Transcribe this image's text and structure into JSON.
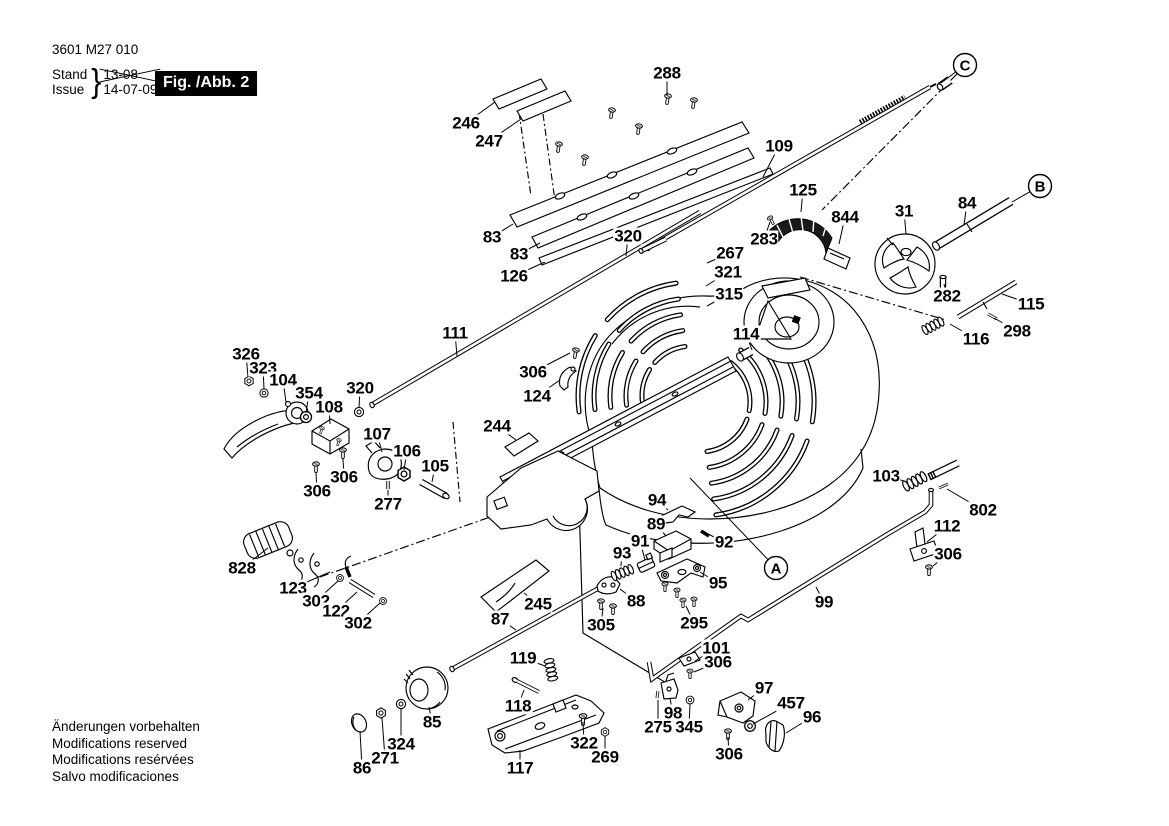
{
  "header": {
    "part_number": "3601 M27 010",
    "stand_label": "Stand",
    "issue_label": "Issue",
    "brace": "}",
    "stand_value": "13-08",
    "issue_value": "14-07-09",
    "figure_label": "Fig. /Abb. 2"
  },
  "footer": {
    "lines": [
      "Änderungen vorbehalten",
      "Modifications reserved",
      "Modifications resérvées",
      "Salvo modificaciones"
    ]
  },
  "colors": {
    "ink": "#000000",
    "paper": "#ffffff",
    "figure_box_bg": "#000000",
    "figure_box_text": "#ffffff"
  },
  "callouts": [
    {
      "letter": "A",
      "x": 776,
      "y": 568,
      "lx": 690,
      "ly": 478
    },
    {
      "letter": "B",
      "x": 1040,
      "y": 186,
      "lx": 1012,
      "ly": 202
    },
    {
      "letter": "C",
      "x": 965,
      "y": 65,
      "lx": 941,
      "ly": 83
    }
  ],
  "part_labels": [
    {
      "text": "288",
      "x": 667,
      "y": 73,
      "lx": 667,
      "ly": 96
    },
    {
      "text": "246",
      "x": 466,
      "y": 123,
      "lx": 495,
      "ly": 102
    },
    {
      "text": "247",
      "x": 489,
      "y": 141,
      "lx": 521,
      "ly": 119
    },
    {
      "text": "83",
      "x": 492,
      "y": 237,
      "lx": 513,
      "ly": 224
    },
    {
      "text": "83",
      "x": 519,
      "y": 254,
      "lx": 540,
      "ly": 243
    },
    {
      "text": "126",
      "x": 514,
      "y": 276,
      "lx": 545,
      "ly": 262
    },
    {
      "text": "320",
      "x": 628,
      "y": 236,
      "lx": 626,
      "ly": 256
    },
    {
      "text": "109",
      "x": 779,
      "y": 146,
      "lx": 763,
      "ly": 177
    },
    {
      "text": "125",
      "x": 803,
      "y": 190,
      "lx": 801,
      "ly": 212
    },
    {
      "text": "844",
      "x": 845,
      "y": 217,
      "lx": 839,
      "ly": 244
    },
    {
      "text": "283",
      "x": 764,
      "y": 239,
      "lx": 770,
      "ly": 222
    },
    {
      "text": "267",
      "x": 730,
      "y": 253,
      "lx": 707,
      "ly": 263
    },
    {
      "text": "321",
      "x": 728,
      "y": 272,
      "lx": 706,
      "ly": 286
    },
    {
      "text": "315",
      "x": 729,
      "y": 294,
      "lx": 707,
      "ly": 306
    },
    {
      "text": "31",
      "x": 904,
      "y": 211,
      "lx": 906,
      "ly": 234
    },
    {
      "text": "84",
      "x": 967,
      "y": 203,
      "lx": 964,
      "ly": 225
    },
    {
      "text": "282",
      "x": 947,
      "y": 296,
      "lx": 944,
      "ly": 284
    },
    {
      "text": "115",
      "x": 1031,
      "y": 304,
      "lx": 1002,
      "ly": 294
    },
    {
      "text": "298",
      "x": 1017,
      "y": 331,
      "lx": 994,
      "ly": 318
    },
    {
      "text": "116",
      "x": 976,
      "y": 339,
      "lx": 950,
      "ly": 324
    },
    {
      "text": "111",
      "x": 455,
      "y": 333,
      "lx": 457,
      "ly": 356
    },
    {
      "text": "114",
      "x": 746,
      "y": 334,
      "lx": 752,
      "ly": 350
    },
    {
      "text": "306",
      "x": 533,
      "y": 372,
      "lx": 570,
      "ly": 353
    },
    {
      "text": "124",
      "x": 537,
      "y": 396,
      "lx": 560,
      "ly": 380
    },
    {
      "text": "244",
      "x": 497,
      "y": 426,
      "lx": 516,
      "ly": 440
    },
    {
      "text": "326",
      "x": 246,
      "y": 354,
      "lx": 248,
      "ly": 377
    },
    {
      "text": "323",
      "x": 263,
      "y": 368,
      "lx": 264,
      "ly": 389
    },
    {
      "text": "104",
      "x": 283,
      "y": 380,
      "lx": 286,
      "ly": 402
    },
    {
      "text": "354",
      "x": 309,
      "y": 393,
      "lx": 306,
      "ly": 413
    },
    {
      "text": "108",
      "x": 329,
      "y": 407,
      "lx": 330,
      "ly": 424
    },
    {
      "text": "320",
      "x": 360,
      "y": 388,
      "lx": 359,
      "ly": 408
    },
    {
      "text": "107",
      "x": 377,
      "y": 434,
      "lx": 382,
      "ly": 452
    },
    {
      "text": "106",
      "x": 407,
      "y": 451,
      "lx": 404,
      "ly": 470
    },
    {
      "text": "105",
      "x": 435,
      "y": 466,
      "lx": 432,
      "ly": 482
    },
    {
      "text": "306",
      "x": 344,
      "y": 477,
      "lx": 343,
      "ly": 459
    },
    {
      "text": "306",
      "x": 317,
      "y": 491,
      "lx": 316,
      "ly": 473
    },
    {
      "text": "277",
      "x": 388,
      "y": 504,
      "lx": 388,
      "ly": 490
    },
    {
      "text": "828",
      "x": 242,
      "y": 568,
      "lx": 268,
      "ly": 548
    },
    {
      "text": "123",
      "x": 293,
      "y": 588,
      "lx": 330,
      "ly": 572
    },
    {
      "text": "302",
      "x": 316,
      "y": 601,
      "lx": 338,
      "ly": 581
    },
    {
      "text": "122",
      "x": 336,
      "y": 611,
      "lx": 357,
      "ly": 592
    },
    {
      "text": "302",
      "x": 358,
      "y": 623,
      "lx": 380,
      "ly": 603
    },
    {
      "text": "87",
      "x": 500,
      "y": 619,
      "lx": 516,
      "ly": 630
    },
    {
      "text": "245",
      "x": 538,
      "y": 604,
      "lx": 524,
      "ly": 593
    },
    {
      "text": "305",
      "x": 601,
      "y": 625,
      "lx": 603,
      "ly": 608
    },
    {
      "text": "88",
      "x": 636,
      "y": 601,
      "lx": 620,
      "ly": 589
    },
    {
      "text": "93",
      "x": 622,
      "y": 553,
      "lx": 621,
      "ly": 566
    },
    {
      "text": "91",
      "x": 640,
      "y": 541,
      "lx": 645,
      "ly": 560
    },
    {
      "text": "89",
      "x": 656,
      "y": 524,
      "lx": 666,
      "ly": 536
    },
    {
      "text": "94",
      "x": 657,
      "y": 500,
      "lx": 668,
      "ly": 510
    },
    {
      "text": "92",
      "x": 724,
      "y": 542,
      "lx": 708,
      "ly": 534
    },
    {
      "text": "95",
      "x": 718,
      "y": 583,
      "lx": 700,
      "ly": 572
    },
    {
      "text": "295",
      "x": 694,
      "y": 623,
      "lx": 686,
      "ly": 606
    },
    {
      "text": "99",
      "x": 824,
      "y": 602,
      "lx": 816,
      "ly": 587
    },
    {
      "text": "103",
      "x": 886,
      "y": 476,
      "lx": 904,
      "ly": 481
    },
    {
      "text": "802",
      "x": 983,
      "y": 510,
      "lx": 947,
      "ly": 489
    },
    {
      "text": "112",
      "x": 947,
      "y": 526,
      "lx": 927,
      "ly": 542
    },
    {
      "text": "306",
      "x": 948,
      "y": 554,
      "lx": 933,
      "ly": 566
    },
    {
      "text": "101",
      "x": 716,
      "y": 648,
      "lx": 695,
      "ly": 661
    },
    {
      "text": "306",
      "x": 718,
      "y": 662,
      "lx": 694,
      "ly": 672
    },
    {
      "text": "119",
      "x": 523,
      "y": 658,
      "lx": 545,
      "ly": 666
    },
    {
      "text": "118",
      "x": 518,
      "y": 706,
      "lx": 524,
      "ly": 690
    },
    {
      "text": "85",
      "x": 432,
      "y": 722,
      "lx": 429,
      "ly": 707
    },
    {
      "text": "324",
      "x": 401,
      "y": 744,
      "lx": 401,
      "ly": 709
    },
    {
      "text": "271",
      "x": 385,
      "y": 758,
      "lx": 382,
      "ly": 718
    },
    {
      "text": "86",
      "x": 362,
      "y": 768,
      "lx": 360,
      "ly": 731
    },
    {
      "text": "117",
      "x": 520,
      "y": 768,
      "lx": 520,
      "ly": 750
    },
    {
      "text": "322",
      "x": 584,
      "y": 743,
      "lx": 583,
      "ly": 722
    },
    {
      "text": "269",
      "x": 605,
      "y": 757,
      "lx": 605,
      "ly": 736
    },
    {
      "text": "97",
      "x": 764,
      "y": 688,
      "lx": 748,
      "ly": 700
    },
    {
      "text": "98",
      "x": 673,
      "y": 713,
      "lx": 670,
      "ly": 699
    },
    {
      "text": "345",
      "x": 689,
      "y": 727,
      "lx": 690,
      "ly": 704
    },
    {
      "text": "275",
      "x": 658,
      "y": 727,
      "lx": 658,
      "ly": 700
    },
    {
      "text": "306",
      "x": 729,
      "y": 754,
      "lx": 728,
      "ly": 737
    },
    {
      "text": "457",
      "x": 791,
      "y": 703,
      "lx": 753,
      "ly": 724
    },
    {
      "text": "96",
      "x": 812,
      "y": 717,
      "lx": 786,
      "ly": 733
    }
  ]
}
